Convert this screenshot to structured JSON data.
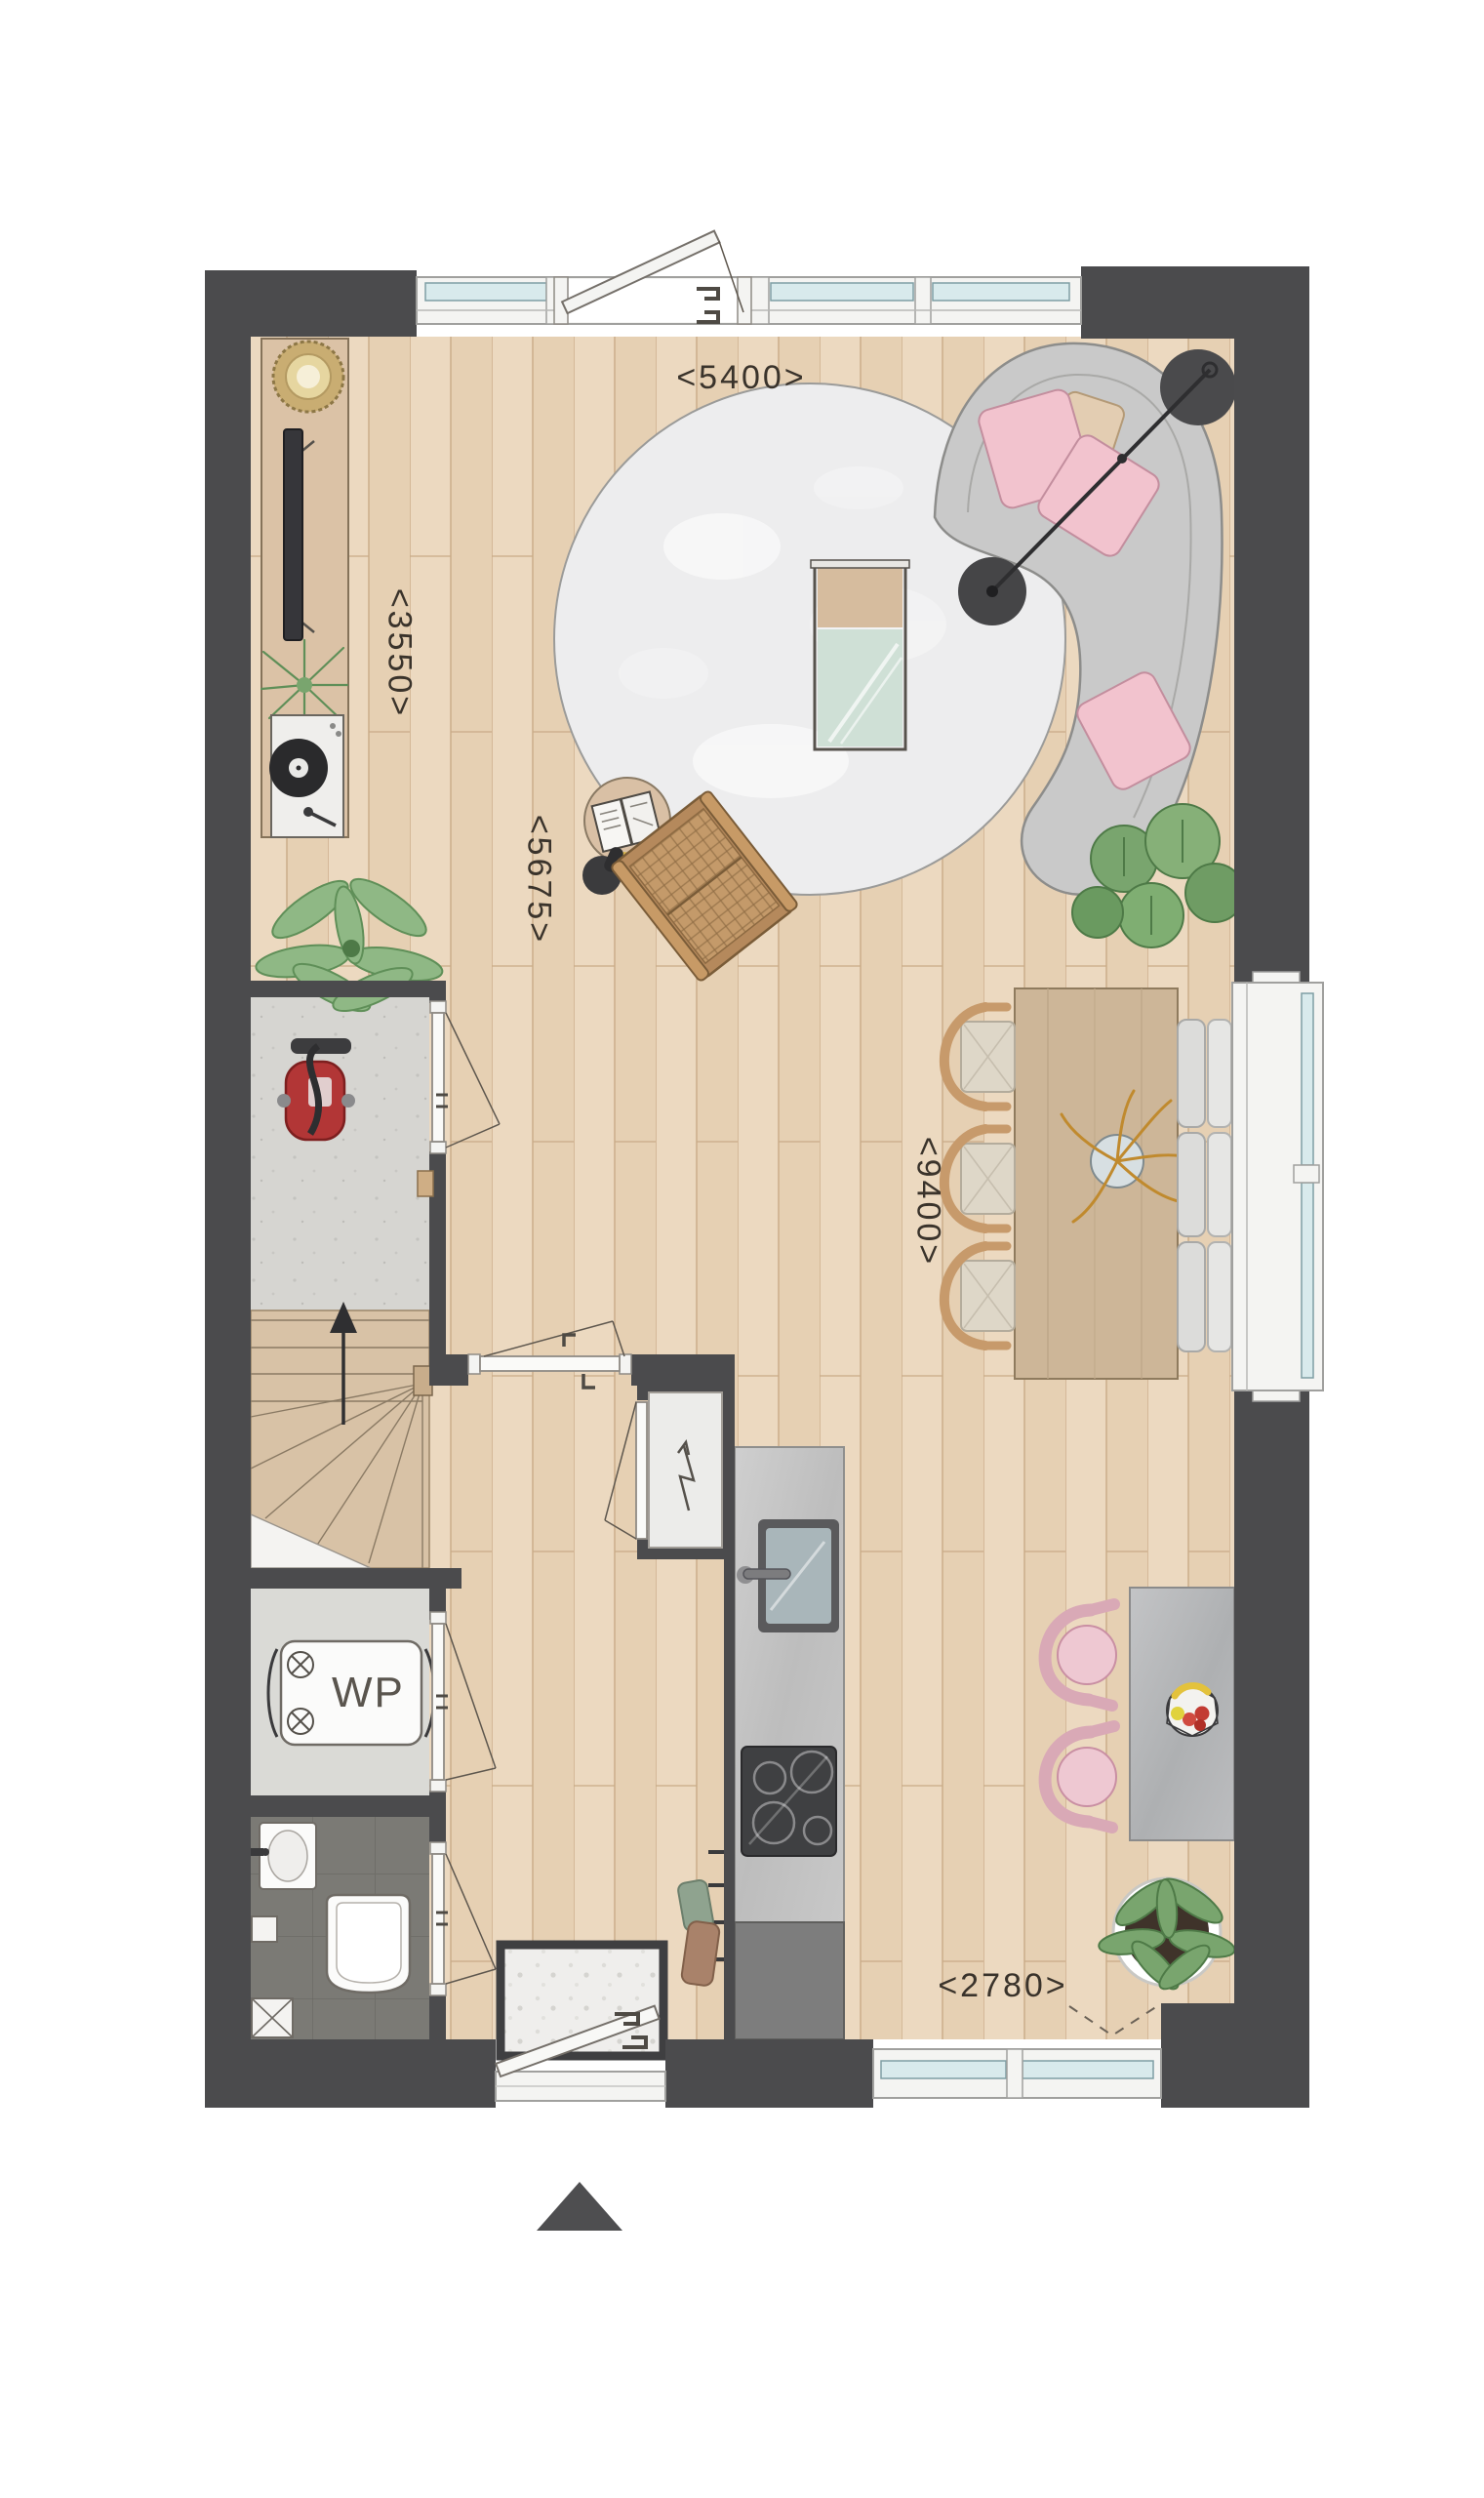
{
  "title": "ground-floor-plan",
  "labels": {
    "dim_top_width": "<5400>",
    "dim_left_height": "<3550>",
    "dim_living_diag": "<5675>",
    "dim_dining_height": "<9400>",
    "dim_kitchen_width": "<2780>",
    "heat_pump": "WP"
  },
  "palette": {
    "wall": "#4b4b4d",
    "floor_wood": "#ecd9c0",
    "plank_line": "#c9ab87",
    "hall_floor": "#d6d5d1",
    "toilet_floor": "#7b7a75",
    "rug": "#ededee",
    "sofa": "#c9c9c9",
    "pillow_pink": "#f2c3ce",
    "chair_pink": "#eec8d2",
    "glazing": "#d8eaec",
    "frame_white": "#f4f4f2",
    "wood_furniture": "#d9c0a5",
    "counter_gray": "#c2c2c2",
    "vacuum_red": "#b23636",
    "plant_green": "#79a56e",
    "accent_gold": "#c08a2e"
  },
  "icons": [
    "north-arrow-icon",
    "lightning-bolt-icon",
    "fan-icon",
    "up-arrow-icon",
    "door-swing-icon",
    "window-icon",
    "drain-icon"
  ],
  "furniture": [
    "curved-sofa",
    "round-rug",
    "coffee-table",
    "arc-floor-lamp",
    "side-table",
    "open-book",
    "reading-lamp",
    "rattan-lounge-chair",
    "sideboard",
    "round-mirror",
    "tv",
    "record-player",
    "aloe-plant",
    "fern-plant",
    "monstera-plant",
    "dining-table",
    "dining-chair",
    "window-bench",
    "gold-centerpiece",
    "kitchen-island",
    "pink-chair",
    "fruit-basket",
    "potted-plant",
    "kitchen-counter",
    "sink",
    "cooktop",
    "tall-cabinet",
    "heat-pump-unit",
    "wash-basin",
    "toilet",
    "doormat",
    "coat-rack",
    "vacuum-cleaner",
    "staircase",
    "meter-cupboard"
  ]
}
